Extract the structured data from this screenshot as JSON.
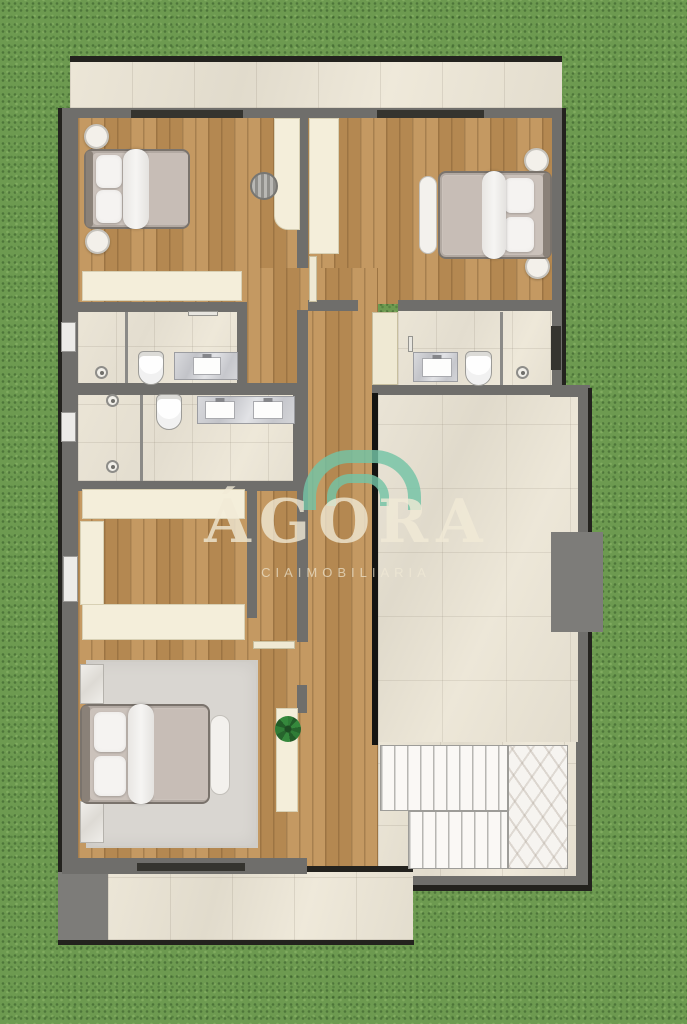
{
  "canvas": {
    "width": 687,
    "height": 1024,
    "background": "grass"
  },
  "watermark": {
    "title": "ÁGORA",
    "subtitle": "CIAIMOBILIARIA",
    "logo_icon": "double-arch-icon",
    "arc_color": "#74c4a6",
    "text_color": "#f2ebd7"
  },
  "palette": {
    "grass": "#6d9a50",
    "wall_gray": "#6f6e6b",
    "outline_dark": "#23221e",
    "wood_floor": "#bf9156",
    "ceramic_tile": "#e7e1d3",
    "furniture_cream": "#f4eeda",
    "marble_vanity": "#ccccd0",
    "stair_marble": "#f6f4f0",
    "bed_linen": "#f5f3f1",
    "rug_gray": "#d9d6d1"
  },
  "scene": {
    "elements": [
      {
        "n": "top-terrace-edge",
        "c": "edge",
        "x": 70,
        "y": 56,
        "w": 492,
        "h": 6
      },
      {
        "n": "top-terrace-floor",
        "c": "tile",
        "x": 70,
        "y": 62,
        "w": 492,
        "h": 46
      },
      {
        "n": "top-terrace-wall",
        "c": "wall",
        "x": 70,
        "y": 108,
        "w": 492,
        "h": 13
      },
      {
        "n": "terrace-door-opening-left",
        "c": "opening",
        "x": 131,
        "y": 110,
        "w": 112,
        "h": 8
      },
      {
        "n": "terrace-door-opening-right",
        "c": "opening",
        "x": 377,
        "y": 110,
        "w": 107,
        "h": 8
      },
      {
        "n": "left-wall-outline",
        "c": "edge",
        "x": 58,
        "y": 108,
        "w": 4,
        "h": 768
      },
      {
        "n": "left-wall",
        "c": "wall",
        "x": 62,
        "y": 108,
        "w": 16,
        "h": 766
      },
      {
        "n": "right-wall-upper",
        "c": "wall",
        "x": 550,
        "y": 108,
        "w": 12,
        "h": 280
      },
      {
        "n": "right-wall-upper-outline",
        "c": "edge",
        "x": 562,
        "y": 108,
        "w": 4,
        "h": 280
      },
      {
        "n": "bedroom1-floor",
        "c": "wood",
        "x": 78,
        "y": 118,
        "w": 222,
        "h": 186
      },
      {
        "n": "bedroom2-floor",
        "c": "wood",
        "x": 308,
        "y": 118,
        "w": 244,
        "h": 186
      },
      {
        "n": "hall-floor",
        "c": "wood",
        "x": 247,
        "y": 268,
        "w": 131,
        "h": 600
      },
      {
        "n": "closet-floor",
        "c": "wood",
        "x": 78,
        "y": 490,
        "w": 169,
        "h": 152
      },
      {
        "n": "master-bedroom-floor",
        "c": "wood",
        "x": 78,
        "y": 640,
        "w": 224,
        "h": 222
      },
      {
        "n": "bathroom1-floor",
        "c": "btile",
        "x": 78,
        "y": 312,
        "w": 160,
        "h": 73
      },
      {
        "n": "bathroom2-floor",
        "c": "btile",
        "x": 78,
        "y": 395,
        "w": 219,
        "h": 86
      },
      {
        "n": "bathroom3-floor",
        "c": "btile",
        "x": 398,
        "y": 310,
        "w": 154,
        "h": 77
      },
      {
        "n": "great-room-floor",
        "c": "rtile",
        "x": 378,
        "y": 395,
        "w": 200,
        "h": 350
      },
      {
        "n": "stair-hall-floor",
        "c": "tile",
        "x": 378,
        "y": 742,
        "w": 200,
        "h": 146
      },
      {
        "n": "bottom-terrace-floor",
        "c": "tile",
        "x": 108,
        "y": 872,
        "w": 305,
        "h": 68
      },
      {
        "n": "terrace-block",
        "c": "wall2",
        "x": 58,
        "y": 872,
        "w": 50,
        "h": 70
      },
      {
        "n": "bottom-terrace-edge",
        "c": "edge",
        "x": 58,
        "y": 940,
        "w": 356,
        "h": 5
      },
      {
        "n": "spine-wall-upper",
        "c": "wall",
        "x": 297,
        "y": 118,
        "w": 11,
        "h": 150
      },
      {
        "n": "spine-wall-lower",
        "c": "wall",
        "x": 297,
        "y": 310,
        "w": 11,
        "h": 332
      },
      {
        "n": "master-east-wall-stub",
        "c": "wall",
        "x": 297,
        "y": 685,
        "w": 10,
        "h": 28
      },
      {
        "n": "bedroom1-south-wall",
        "c": "wall",
        "x": 62,
        "y": 302,
        "w": 185,
        "h": 10
      },
      {
        "n": "bedroom2-south-wall-west",
        "c": "wall",
        "x": 308,
        "y": 300,
        "w": 50,
        "h": 11
      },
      {
        "n": "bedroom2-south-wall-east",
        "c": "wall",
        "x": 398,
        "y": 300,
        "w": 154,
        "h": 11
      },
      {
        "n": "bathroom1-east-wall",
        "c": "wall",
        "x": 237,
        "y": 302,
        "w": 10,
        "h": 90
      },
      {
        "n": "bathrooms-divider-wall",
        "c": "wall",
        "x": 62,
        "y": 383,
        "w": 245,
        "h": 12
      },
      {
        "n": "bathroom2-south-wall",
        "c": "wall",
        "x": 62,
        "y": 481,
        "w": 245,
        "h": 10
      },
      {
        "n": "bathroom2-east-wall",
        "c": "wall",
        "x": 293,
        "y": 393,
        "w": 15,
        "h": 90
      },
      {
        "n": "bathroom3-south-wall",
        "c": "wall",
        "x": 372,
        "y": 385,
        "w": 180,
        "h": 10
      },
      {
        "n": "wall-step-connector",
        "c": "wall",
        "x": 550,
        "y": 385,
        "w": 40,
        "h": 12
      },
      {
        "n": "right-wall-lower",
        "c": "wall",
        "x": 578,
        "y": 388,
        "w": 10,
        "h": 498
      },
      {
        "n": "right-wall-lower-outline",
        "c": "edge",
        "x": 588,
        "y": 388,
        "w": 4,
        "h": 502
      },
      {
        "n": "great-room-west-edge",
        "c": "edgeblack",
        "x": 372,
        "y": 393,
        "w": 6,
        "h": 352
      },
      {
        "n": "closet-east-wall",
        "c": "wall",
        "x": 247,
        "y": 490,
        "w": 10,
        "h": 128
      },
      {
        "n": "master-south-wall",
        "c": "wall",
        "x": 62,
        "y": 858,
        "w": 245,
        "h": 16
      },
      {
        "n": "master-window-opening",
        "c": "opening",
        "x": 137,
        "y": 863,
        "w": 108,
        "h": 8
      },
      {
        "n": "hall-terrace-threshold",
        "c": "edge",
        "x": 307,
        "y": 866,
        "w": 106,
        "h": 6
      },
      {
        "n": "stair-hall-south-wall",
        "c": "wall",
        "x": 413,
        "y": 876,
        "w": 165,
        "h": 9
      },
      {
        "n": "stair-hall-south-outline",
        "c": "edge",
        "x": 413,
        "y": 885,
        "w": 179,
        "h": 6
      },
      {
        "n": "stair-east-wall",
        "c": "wall",
        "x": 576,
        "y": 742,
        "w": 12,
        "h": 140
      },
      {
        "n": "fireplace-block",
        "c": "wall2",
        "x": 551,
        "y": 532,
        "w": 52,
        "h": 100
      },
      {
        "n": "left-window-1",
        "c": "window",
        "x": 61,
        "y": 322,
        "w": 15,
        "h": 30
      },
      {
        "n": "left-window-2",
        "c": "window",
        "x": 61,
        "y": 412,
        "w": 15,
        "h": 30
      },
      {
        "n": "left-window-3",
        "c": "window",
        "x": 63,
        "y": 556,
        "w": 15,
        "h": 46
      },
      {
        "n": "right-window-bath",
        "c": "opening",
        "x": 551,
        "y": 326,
        "w": 10,
        "h": 44
      },
      {
        "n": "bath1-shower-divider",
        "c": "thinwall",
        "x": 125,
        "y": 312,
        "w": 3,
        "h": 71
      },
      {
        "n": "bath1-shower-drain-icon",
        "c": "drain",
        "x": 95,
        "y": 366,
        "w": 13,
        "h": 13
      },
      {
        "n": "bath1-toilet",
        "c": "toilet",
        "x": 138,
        "y": 351,
        "w": 26,
        "h": 34
      },
      {
        "n": "bath1-vanity",
        "c": "vanity",
        "x": 174,
        "y": 352,
        "w": 64,
        "h": 28,
        "children": [
          {
            "n": "bath1-sink",
            "c": "sink",
            "x": 18,
            "y": 4,
            "w": 28,
            "h": 18
          }
        ]
      },
      {
        "n": "bath1-towel-bar",
        "c": "towel",
        "x": 188,
        "y": 311,
        "w": 30,
        "h": 5
      },
      {
        "n": "bath2-shower-divider",
        "c": "thinwall",
        "x": 140,
        "y": 395,
        "w": 3,
        "h": 86
      },
      {
        "n": "bath2-shower-drain-icon",
        "c": "drain",
        "x": 106,
        "y": 394,
        "w": 13,
        "h": 13
      },
      {
        "n": "bath2-shower-drain2-icon",
        "c": "drain",
        "x": 106,
        "y": 460,
        "w": 13,
        "h": 13
      },
      {
        "n": "bath2-toilet",
        "c": "toilet",
        "x": 156,
        "y": 394,
        "w": 26,
        "h": 36
      },
      {
        "n": "bath2-vanity",
        "c": "vanity",
        "x": 197,
        "y": 396,
        "w": 98,
        "h": 28,
        "children": [
          {
            "n": "bath2-sink-left",
            "c": "sink",
            "x": 7,
            "y": 4,
            "w": 30,
            "h": 18
          },
          {
            "n": "bath2-sink-right",
            "c": "sink",
            "x": 55,
            "y": 4,
            "w": 30,
            "h": 18
          }
        ]
      },
      {
        "n": "bath3-shower-divider",
        "c": "thinwall",
        "x": 500,
        "y": 312,
        "w": 3,
        "h": 73
      },
      {
        "n": "bath3-shower-drain-icon",
        "c": "drain",
        "x": 516,
        "y": 366,
        "w": 13,
        "h": 13
      },
      {
        "n": "bath3-toilet",
        "c": "toilet",
        "x": 465,
        "y": 351,
        "w": 27,
        "h": 35
      },
      {
        "n": "bath3-vanity",
        "c": "vanity",
        "x": 413,
        "y": 352,
        "w": 45,
        "h": 30,
        "children": [
          {
            "n": "bath3-sink",
            "c": "sink",
            "x": 8,
            "y": 5,
            "w": 30,
            "h": 19
          }
        ]
      },
      {
        "n": "bath3-towel-bar",
        "c": "towel",
        "x": 408,
        "y": 336,
        "w": 5,
        "h": 16
      },
      {
        "n": "bedroom1-door-leaf",
        "c": "door",
        "x": 309,
        "y": 256,
        "w": 8,
        "h": 46
      },
      {
        "n": "bath3-door-leaf",
        "c": "door",
        "x": 372,
        "y": 312,
        "w": 26,
        "h": 73
      },
      {
        "n": "master-door-leaf",
        "c": "door",
        "x": 253,
        "y": 641,
        "w": 42,
        "h": 8
      },
      {
        "n": "bedroom1-nightstand-top",
        "c": "roundtable",
        "x": 84,
        "y": 124,
        "w": 25,
        "h": 25
      },
      {
        "n": "bedroom1-nightstand-bottom",
        "c": "roundtable",
        "x": 85,
        "y": 229,
        "w": 25,
        "h": 25
      },
      {
        "n": "bedroom1-bed",
        "c": "bed",
        "x": 84,
        "y": 149,
        "w": 106,
        "h": 80,
        "children": [
          {
            "n": "bed-headboard",
            "c": "headboard",
            "x": 0,
            "y": 0,
            "w": 7,
            "h": 76
          },
          {
            "n": "bed-mattress",
            "c": "mattress",
            "x": 7,
            "y": 2,
            "w": 95,
            "h": 72
          },
          {
            "n": "bed-pillow",
            "c": "pillow",
            "x": 10,
            "y": 4,
            "w": 26,
            "h": 33
          },
          {
            "n": "bed-pillow",
            "c": "pillow",
            "x": 10,
            "y": 39,
            "w": 26,
            "h": 33
          },
          {
            "n": "bed-duvet",
            "c": "duvet",
            "x": 37,
            "y": -2,
            "w": 26,
            "h": 80
          },
          {
            "n": "bed-blanket",
            "c": "blanket",
            "x": 63,
            "y": 2,
            "w": 39,
            "h": 72
          }
        ]
      },
      {
        "n": "bedroom1-desk",
        "c": "cream",
        "x": 274,
        "y": 118,
        "w": 26,
        "h": 112,
        "r": "0 0 0 14px"
      },
      {
        "n": "bedroom1-chair",
        "c": "chair",
        "x": 250,
        "y": 172,
        "w": 28,
        "h": 28
      },
      {
        "n": "bedroom1-dresser",
        "c": "cream",
        "x": 82,
        "y": 271,
        "w": 160,
        "h": 30
      },
      {
        "n": "bedroom2-wardrobe",
        "c": "cream",
        "x": 309,
        "y": 118,
        "w": 30,
        "h": 136
      },
      {
        "n": "bedroom2-nightstand-top",
        "c": "roundtable",
        "x": 524,
        "y": 148,
        "w": 25,
        "h": 25
      },
      {
        "n": "bedroom2-nightstand-bottom",
        "c": "roundtable",
        "x": 525,
        "y": 254,
        "w": 25,
        "h": 25
      },
      {
        "n": "bedroom2-bed",
        "c": "bed",
        "x": 438,
        "y": 171,
        "w": 114,
        "h": 88,
        "children": [
          {
            "n": "bed-headboard",
            "c": "headboard",
            "x": 103,
            "y": 0,
            "w": 7,
            "h": 84
          },
          {
            "n": "bed-mattress",
            "c": "mattress",
            "x": 2,
            "y": 2,
            "w": 101,
            "h": 80
          },
          {
            "n": "bed-pillow",
            "c": "pillow",
            "x": 64,
            "y": 5,
            "w": 30,
            "h": 35
          },
          {
            "n": "bed-pillow",
            "c": "pillow",
            "x": 64,
            "y": 44,
            "w": 30,
            "h": 35
          },
          {
            "n": "bed-duvet",
            "c": "duvet",
            "x": 42,
            "y": -2,
            "w": 24,
            "h": 88
          },
          {
            "n": "bed-blanket",
            "c": "blanket",
            "x": 3,
            "y": 3,
            "w": 39,
            "h": 78
          }
        ]
      },
      {
        "n": "bedroom2-bench",
        "c": "benchv",
        "x": 419,
        "y": 176,
        "w": 18,
        "h": 78
      },
      {
        "n": "closet-wardrobe-top",
        "c": "cream",
        "x": 82,
        "y": 489,
        "w": 163,
        "h": 30
      },
      {
        "n": "closet-wardrobe-left",
        "c": "cream",
        "x": 80,
        "y": 521,
        "w": 24,
        "h": 84
      },
      {
        "n": "closet-wardrobe-bottom",
        "c": "cream",
        "x": 82,
        "y": 604,
        "w": 163,
        "h": 36
      },
      {
        "n": "master-rug",
        "c": "rug",
        "x": 86,
        "y": 660,
        "w": 172,
        "h": 188
      },
      {
        "n": "master-nightstand-top",
        "c": "nstand",
        "x": 80,
        "y": 664,
        "w": 24,
        "h": 40
      },
      {
        "n": "master-nightstand-bottom",
        "c": "nstand",
        "x": 80,
        "y": 801,
        "w": 24,
        "h": 42
      },
      {
        "n": "master-bed",
        "c": "bed",
        "x": 80,
        "y": 704,
        "w": 130,
        "h": 100,
        "children": [
          {
            "n": "bed-headboard",
            "c": "headboard",
            "x": 0,
            "y": 0,
            "w": 8,
            "h": 96
          },
          {
            "n": "bed-mattress",
            "c": "mattress",
            "x": 8,
            "y": 2,
            "w": 118,
            "h": 92
          },
          {
            "n": "bed-pillow",
            "c": "pillow",
            "x": 12,
            "y": 6,
            "w": 32,
            "h": 40
          },
          {
            "n": "bed-pillow",
            "c": "pillow",
            "x": 12,
            "y": 50,
            "w": 32,
            "h": 40
          },
          {
            "n": "bed-duvet",
            "c": "duvet",
            "x": 46,
            "y": -2,
            "w": 26,
            "h": 100
          },
          {
            "n": "bed-blanket",
            "c": "blanket",
            "x": 72,
            "y": 3,
            "w": 54,
            "h": 90
          }
        ]
      },
      {
        "n": "master-bench",
        "c": "benchv",
        "x": 210,
        "y": 715,
        "w": 20,
        "h": 80
      },
      {
        "n": "master-console",
        "c": "cream",
        "x": 276,
        "y": 708,
        "w": 22,
        "h": 104
      },
      {
        "n": "plant-icon",
        "c": "plant",
        "x": 275,
        "y": 716,
        "w": 26,
        "h": 26
      },
      {
        "n": "stair-landing",
        "c": "chevron",
        "x": 508,
        "y": 745,
        "w": 60,
        "h": 124
      },
      {
        "n": "stairs-upper-flight",
        "c": "stairs",
        "x": 380,
        "y": 745,
        "w": 128,
        "h": 66
      },
      {
        "n": "stairs-lower-flight",
        "c": "stairs",
        "x": 408,
        "y": 811,
        "w": 100,
        "h": 58
      }
    ]
  }
}
